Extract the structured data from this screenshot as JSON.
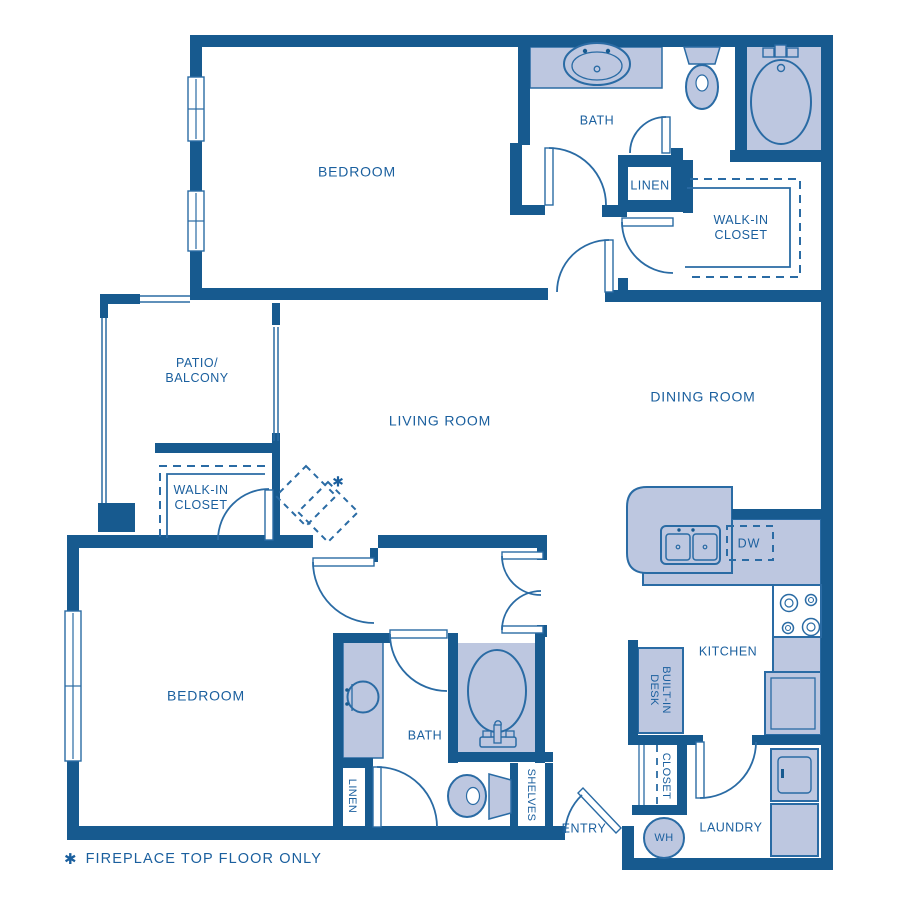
{
  "plan": {
    "rooms": {
      "bedroom_top": "BEDROOM",
      "bath_top": "BATH",
      "linen_top": "LINEN",
      "walkin_top_l1": "WALK-IN",
      "walkin_top_l2": "CLOSET",
      "patio_l1": "PATIO/",
      "patio_l2": "BALCONY",
      "living": "LIVING ROOM",
      "dining": "DINING ROOM",
      "walkin_mid_l1": "WALK-IN",
      "walkin_mid_l2": "CLOSET",
      "bedroom_bottom": "BEDROOM",
      "bath_bottom": "BATH",
      "linen_bottom": "LINEN",
      "shelves": "SHELVES",
      "entry": "ENTRY",
      "desk_l1": "BUILT-IN",
      "desk_l2": "DESK",
      "closet_bottom": "CLOSET",
      "kitchen": "KITCHEN",
      "laundry": "LAUNDRY"
    },
    "fixtures": {
      "dw": "DW",
      "wh": "WH",
      "fireplace_mark": "✱"
    },
    "note": {
      "star": "✱",
      "text": "FIREPLACE TOP FLOOR ONLY"
    },
    "colors": {
      "wall": "#175A8F",
      "fill": "#BDC7E0",
      "line": "#2A6BA4",
      "text": "#1A5F9E",
      "bg": "#FFFFFF"
    }
  }
}
